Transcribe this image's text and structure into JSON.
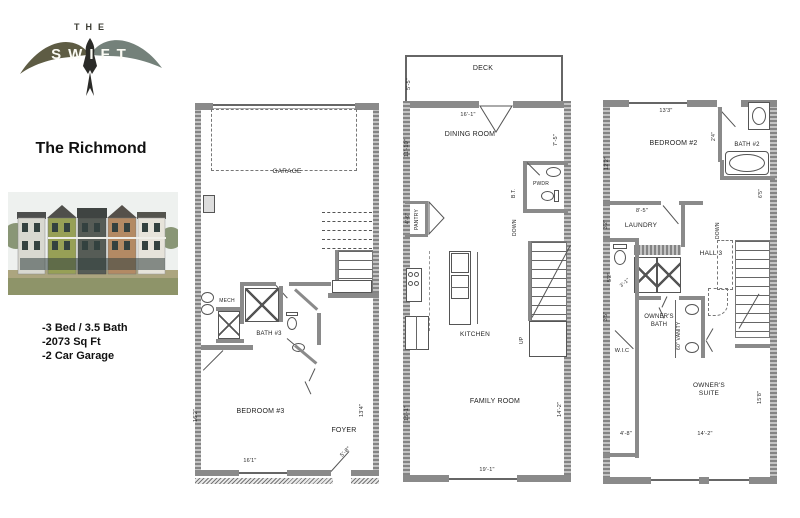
{
  "branding": {
    "logo_top": "THE",
    "logo_name": "SWIFT",
    "model_name": "The Richmond"
  },
  "specs": [
    "-3 Bed / 3.5 Bath",
    "-2073 Sq Ft",
    "-2 Car Garage"
  ],
  "floor1": {
    "garage": "GARAGE",
    "mech": "MECH",
    "bath": "BATH #3",
    "bedroom": "BEDROOM #3",
    "foyer": "FOYER",
    "dim_left": "16'2\"",
    "dim_right": "13'4\"",
    "dim_bottom": "16'1\"",
    "dim_door": "5'-8\""
  },
  "floor2": {
    "deck": "DECK",
    "dim_deck": "5'-5\"",
    "dim_top": "16'-1\"",
    "dining": "DINING ROOM",
    "dim_dining_left": "11'-10\"",
    "dim_dining_right": "7'-5\"",
    "pwdr": "PWDR",
    "bt": "B.T.",
    "pantry": "PANTRY",
    "dim_pantry": "4'-6\"",
    "down": "DOWN",
    "up": "UP",
    "kitchen": "KITCHEN",
    "family": "FAMILY ROOM",
    "dim_left": "15'-1\"",
    "dim_right": "14'-2\"",
    "dim_bottom": "19'-1\""
  },
  "floor3": {
    "dim_top": "13'3\"",
    "bedroom": "BEDROOM #2",
    "dim_left": "12'2\"",
    "bath": "BATH #2",
    "dim_bath": "2'4\"",
    "dim_bath_right": "6'5\"",
    "dim_85": "8'-5\"",
    "dim_laundry": "3'2\"",
    "laundry": "LAUNDRY",
    "hall": "HALL 3",
    "down": "DOWN",
    "dim_wc1": "5'2\"",
    "dim_wc2": "3'-1\"",
    "owners_bath": "OWNER'S BATH",
    "vanity": "60\" VANITY",
    "wic": "W.I.C",
    "dim_wic": "3'5\"",
    "dim_48": "4'-8\"",
    "suite": "OWNER'S SUITE",
    "dim_suite_right": "15'8\"",
    "dim_suite_bottom": "14'-2\""
  }
}
